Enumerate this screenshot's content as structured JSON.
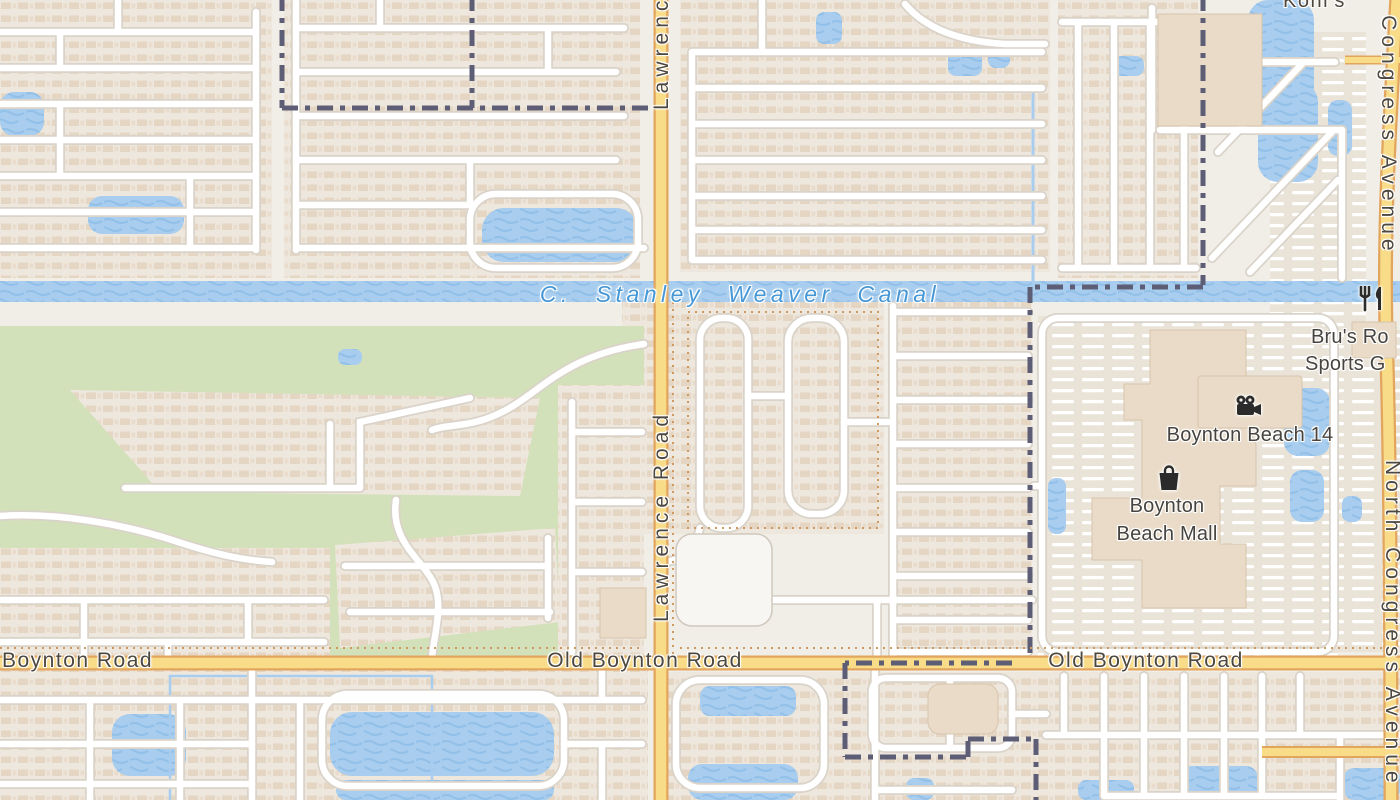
{
  "map": {
    "kind": "road-map-tile"
  },
  "colors": {
    "land": "#f1eee7",
    "residential": "#eee7dd",
    "green_area": "#d3e1ba",
    "water": "#a8cdee",
    "road_major_fill": "#f8dc88",
    "road_major_casing": "#e2a55e",
    "road_minor_fill": "#ffffff",
    "road_minor_casing": "#d9d3c9",
    "boundary": "#5d5d75",
    "building": "#e9dbc8",
    "canal_label": "#4697d6",
    "road_label": "#4d473e",
    "poi_label": "#474440"
  },
  "labels": {
    "canal": "C. Stanley Weaver Canal",
    "lawrence_road": "Lawrence Road",
    "lawrence_road_top": "Lawrence Road",
    "old_boynton_left": "Boynton Road",
    "old_boynton_center": "Old Boynton Road",
    "old_boynton_right": "Old Boynton Road",
    "congress_avenue_top": "North Congress Avenue",
    "congress_avenue_bottom": "North Congress Avenue",
    "kohls": "Kohl's"
  },
  "pois": [
    {
      "icon": "restaurant-icon",
      "line1": "Bru's Ro",
      "line2": "Sports G"
    },
    {
      "icon": "cinema-icon",
      "line1": "Boynton Beach 14"
    },
    {
      "icon": "shopping-bag-icon",
      "line1": "Boynton",
      "line2": "Beach Mall"
    }
  ]
}
